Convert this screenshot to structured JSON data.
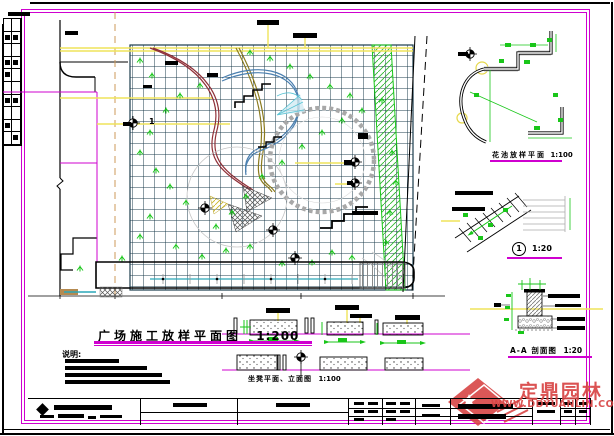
{
  "labels": {
    "main_plan": {
      "title": "广场施工放样平面图",
      "scale": "1:200"
    },
    "planter_plan": {
      "title": "花池放样平面",
      "scale": "1:100"
    },
    "stair_detail": {
      "number": "1",
      "scale": "1:20"
    },
    "section": {
      "title": "A-A 剖面图",
      "scale": "1:20"
    },
    "bench_elevation": {
      "title": "坐凳平面、立面图",
      "scale": "1:100"
    },
    "notes_heading": "说明:",
    "plan_marker_number": "1"
  },
  "watermark": {
    "brand": "定鼎园林",
    "url": "WWW.DDYUANLIN.COM"
  },
  "colors": {
    "frame": "#cf00cf",
    "grid": "#1c3c4c",
    "yellow": "#efe45a",
    "green": "#19c619",
    "maroon": "#8f3038",
    "olive": "#8a7a1e",
    "blue": "#4a7faf",
    "cyan": "#59c3d4",
    "watermark_red": "#d84545"
  }
}
